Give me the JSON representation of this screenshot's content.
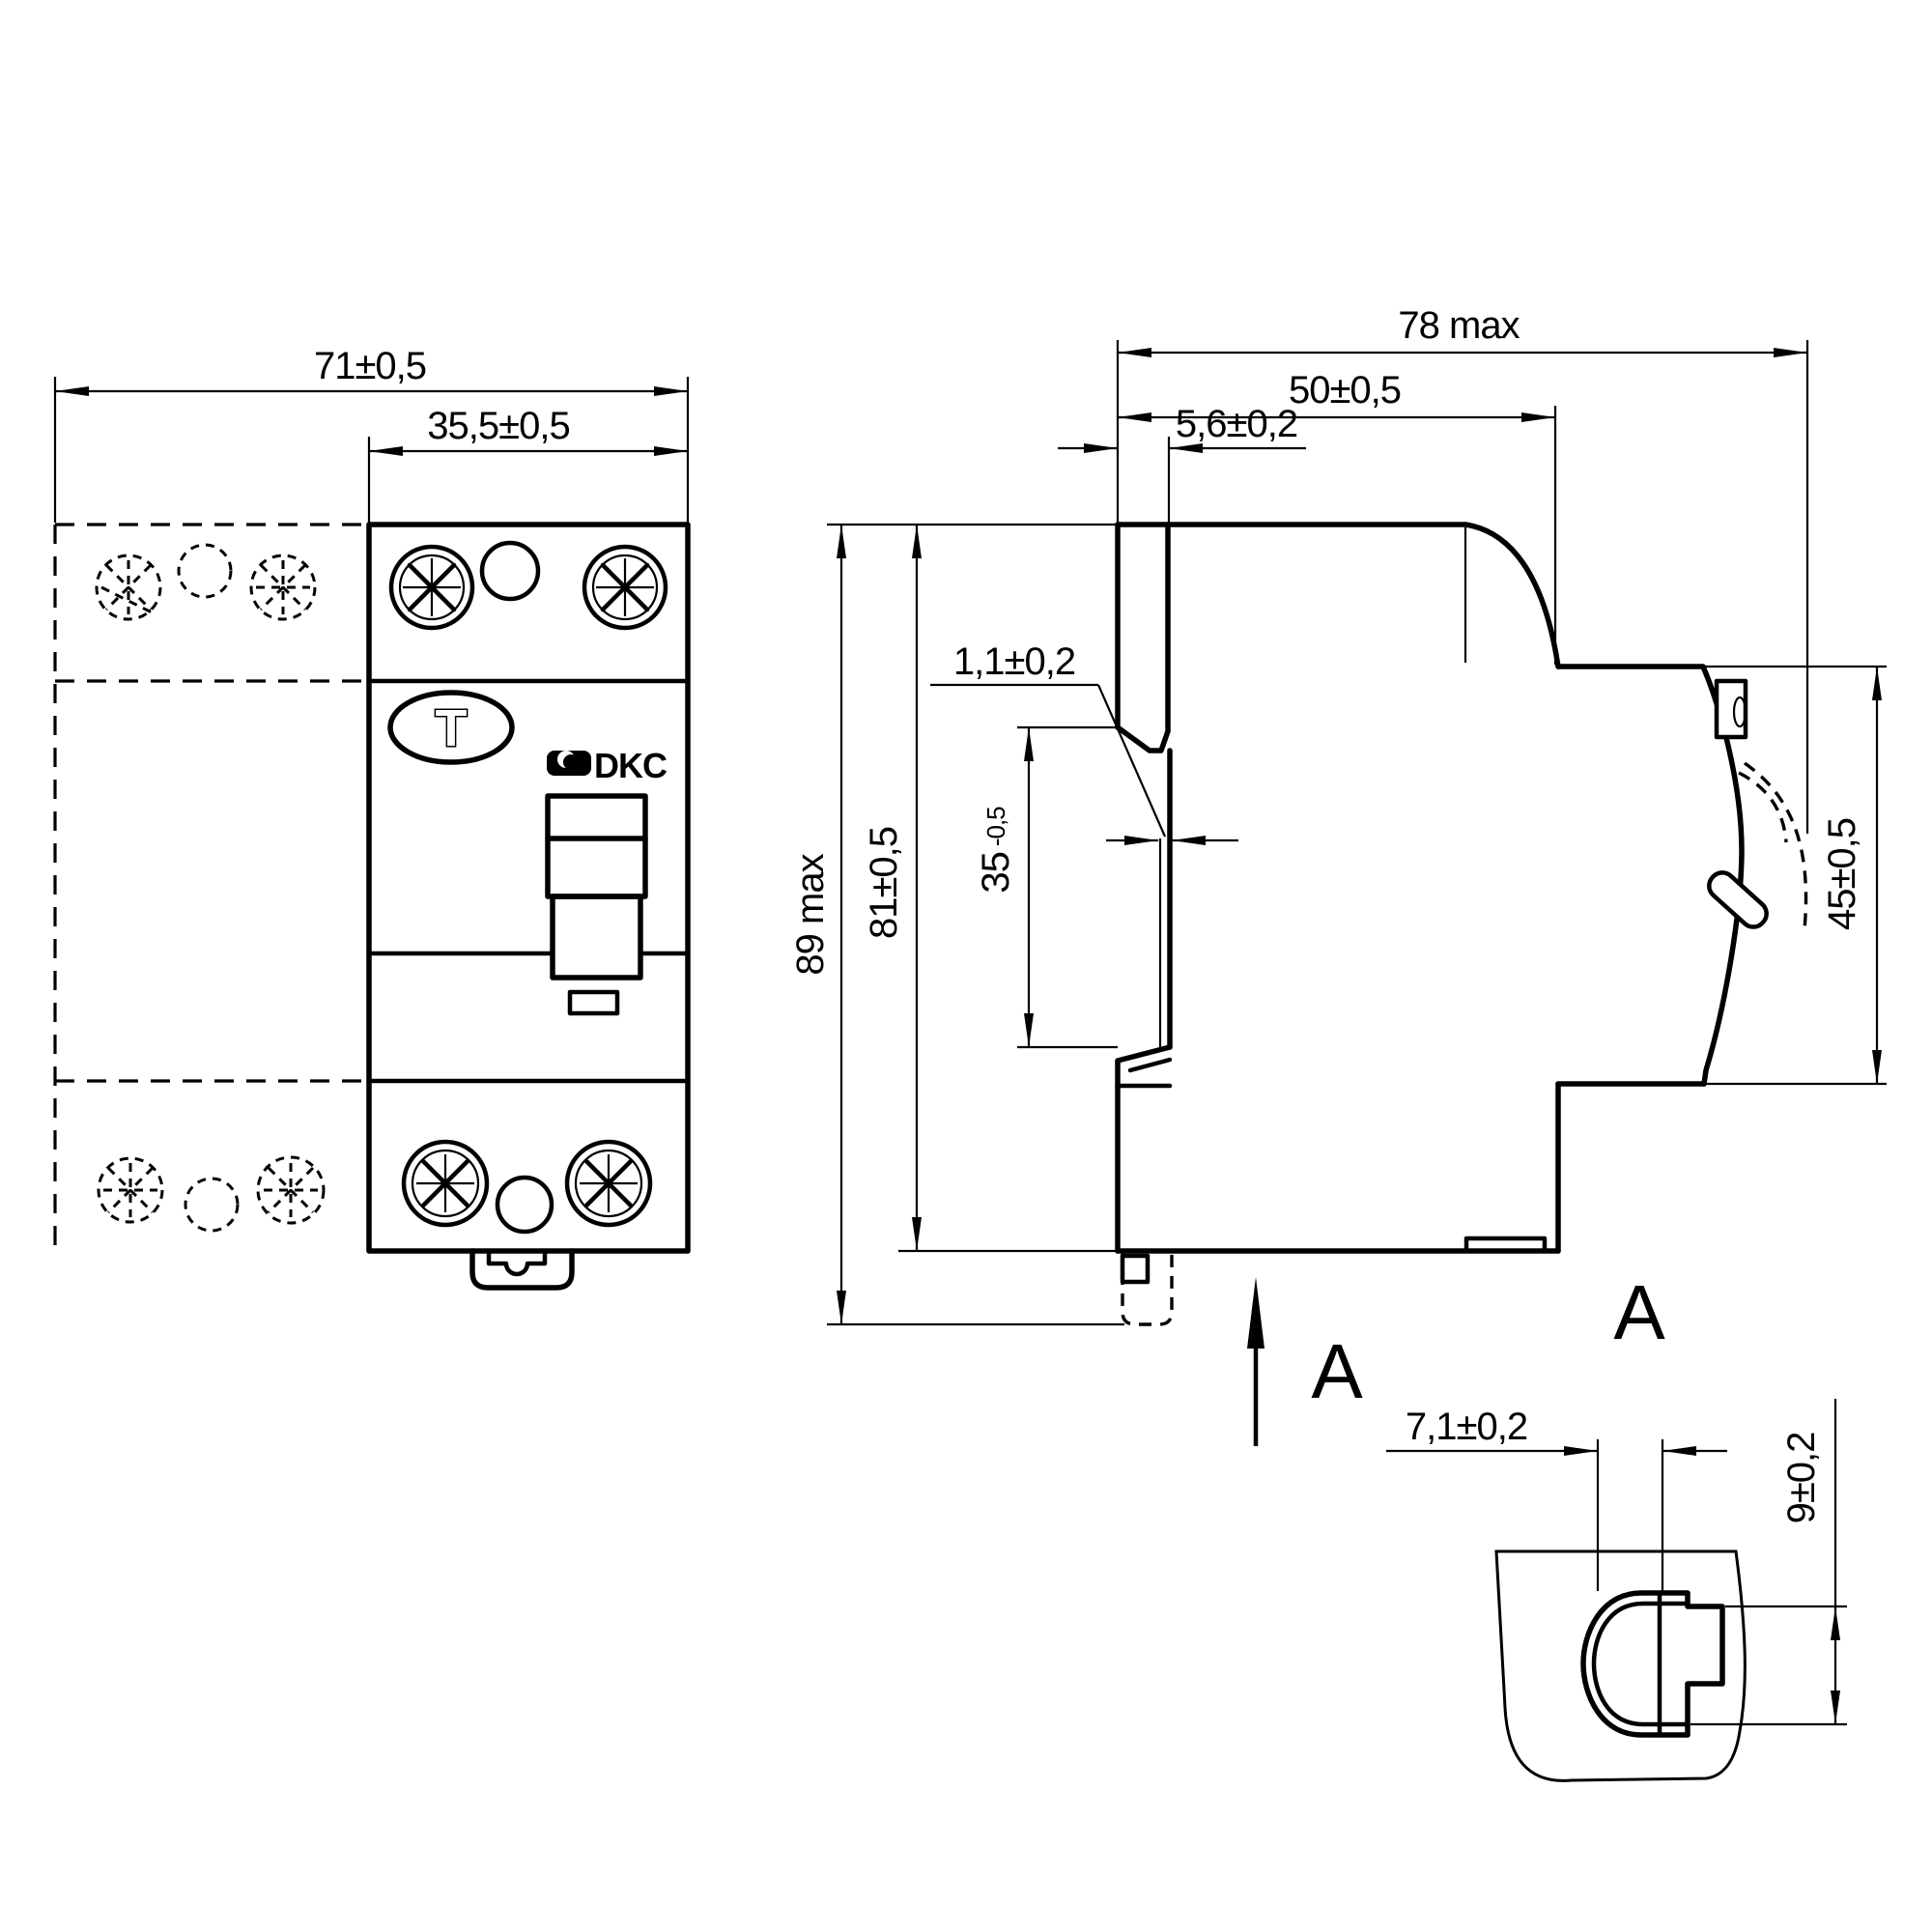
{
  "drawing": {
    "title": "DIN-rail residual current device - dimensional drawing",
    "colors": {
      "line": "#000000",
      "background": "#ffffff"
    },
    "front_view": {
      "dim_total_width": "71±0,5",
      "dim_module_width": "35,5±0,5",
      "test_button_label": "T",
      "brand": "DKC"
    },
    "side_view": {
      "dim_depth_max": "78 max",
      "dim_depth_body": "50±0,5",
      "dim_rail_recess": "5,6±0,2",
      "dim_clip_gap": "1,1±0,2",
      "dim_rail_width": "35",
      "dim_rail_width_tol": "-0,5",
      "dim_height_body": "81±0,5",
      "dim_height_max": "89 max",
      "dim_front_face": "45±0,5",
      "section_arrow_label": "A"
    },
    "detail_view": {
      "title": "A",
      "dim_clip_width": "7,1±0,2",
      "dim_clip_height": "9±0,2"
    }
  }
}
